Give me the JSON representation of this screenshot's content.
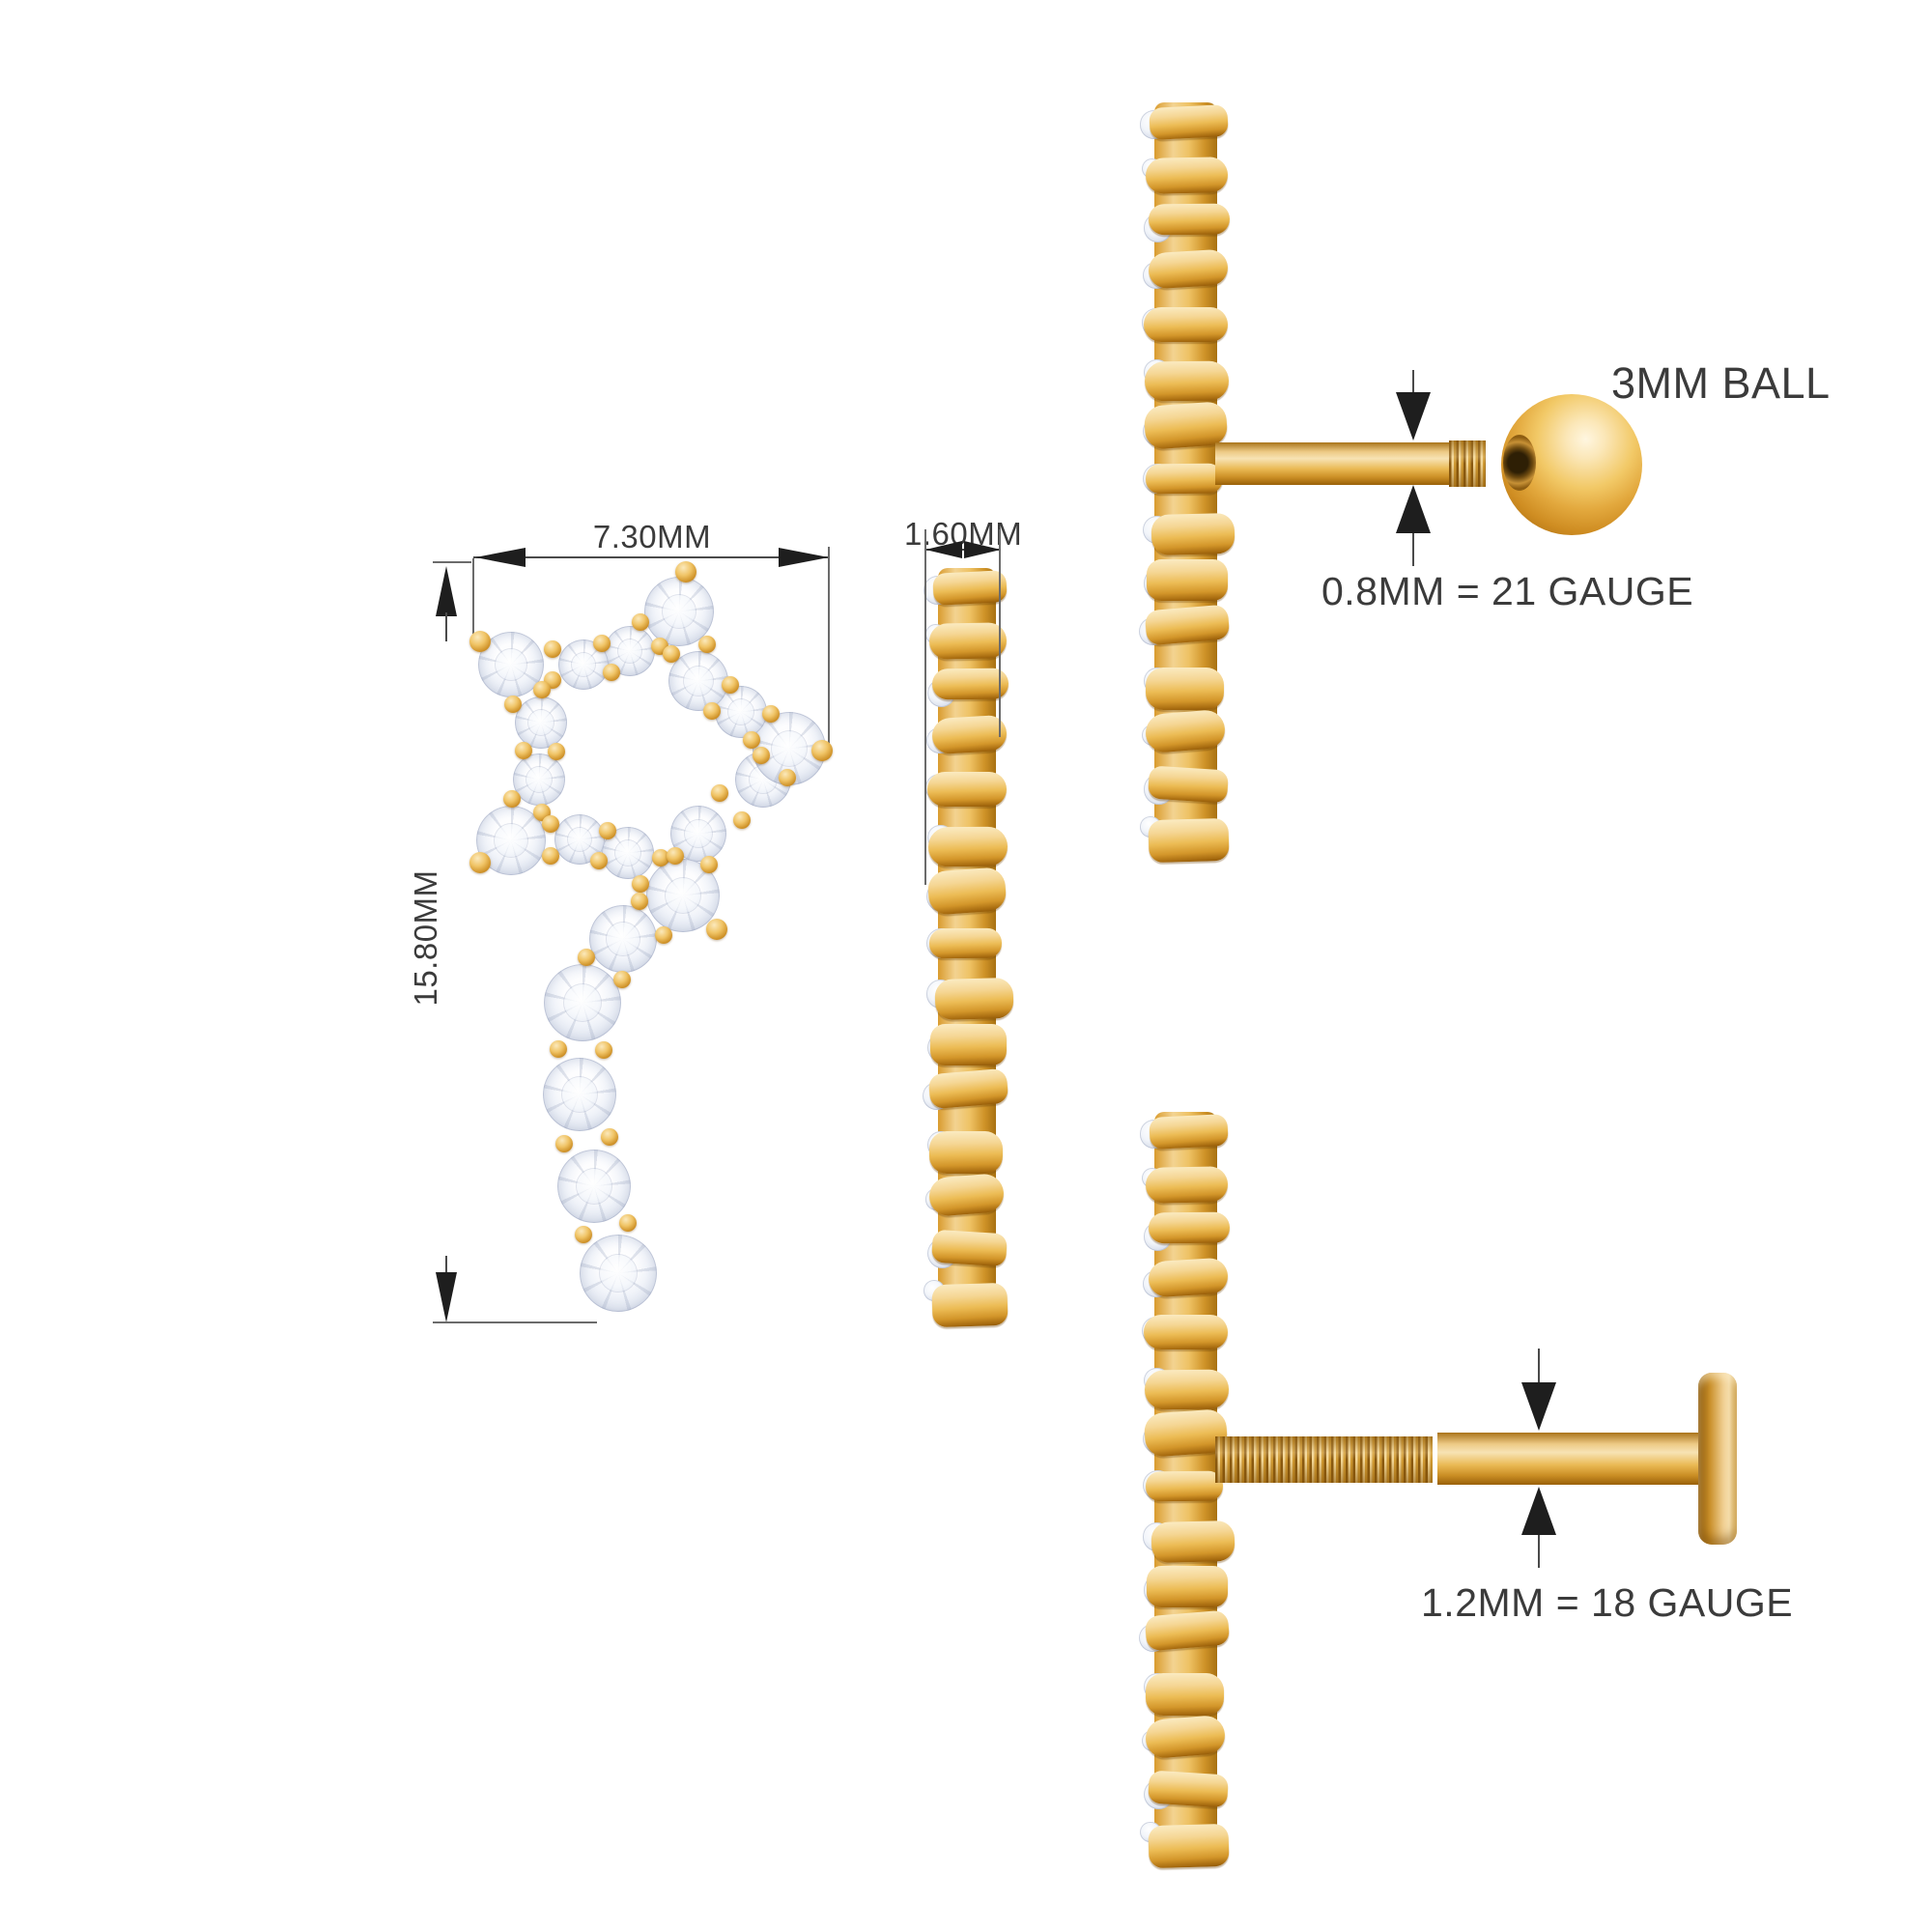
{
  "page": {
    "background": "#ffffff"
  },
  "front_view": {
    "width_label": "7.30MM",
    "height_label": "15.80MM",
    "stones": [
      [
        703,
        633,
        36
      ],
      [
        652,
        674,
        26
      ],
      [
        604,
        688,
        26
      ],
      [
        529,
        688,
        34
      ],
      [
        560,
        748,
        27
      ],
      [
        558,
        807,
        27
      ],
      [
        529,
        870,
        36
      ],
      [
        600,
        869,
        26
      ],
      [
        650,
        883,
        27
      ],
      [
        707,
        927,
        38
      ],
      [
        723,
        863,
        29
      ],
      [
        790,
        807,
        29
      ],
      [
        817,
        775,
        38
      ],
      [
        767,
        737,
        27
      ],
      [
        723,
        705,
        31
      ],
      [
        645,
        972,
        35
      ],
      [
        603,
        1038,
        40
      ],
      [
        600,
        1133,
        38
      ],
      [
        615,
        1228,
        38
      ],
      [
        640,
        1318,
        40
      ]
    ],
    "chains": [
      [
        0,
        1,
        2,
        3,
        4,
        5,
        6,
        7,
        8,
        9,
        10,
        11,
        12,
        13,
        14,
        0
      ],
      [
        9,
        15,
        16,
        17,
        18,
        19
      ]
    ],
    "tip_prongs": [
      [
        710,
        592
      ],
      [
        497,
        664
      ],
      [
        497,
        893
      ],
      [
        851,
        777
      ],
      [
        742,
        962
      ]
    ]
  },
  "side_view": {
    "depth_label": "1.60MM"
  },
  "post_ball_view": {
    "ball_label": "3MM BALL",
    "gauge_label": "0.8MM = 21 GAUGE"
  },
  "post_flat_view": {
    "gauge_label": "1.2MM = 18 GAUGE"
  },
  "colors": {
    "gold_light": "#fae7bb",
    "gold_mid": "#eec269",
    "gold_deep": "#c1831d",
    "gold_dark": "#9a600c",
    "diamond_hi": "#ffffff",
    "diamond_lo": "#c7cfe0",
    "text": "#3b3b3b",
    "dim_line": "#4a4a4a",
    "arrow": "#1e1e1e"
  }
}
